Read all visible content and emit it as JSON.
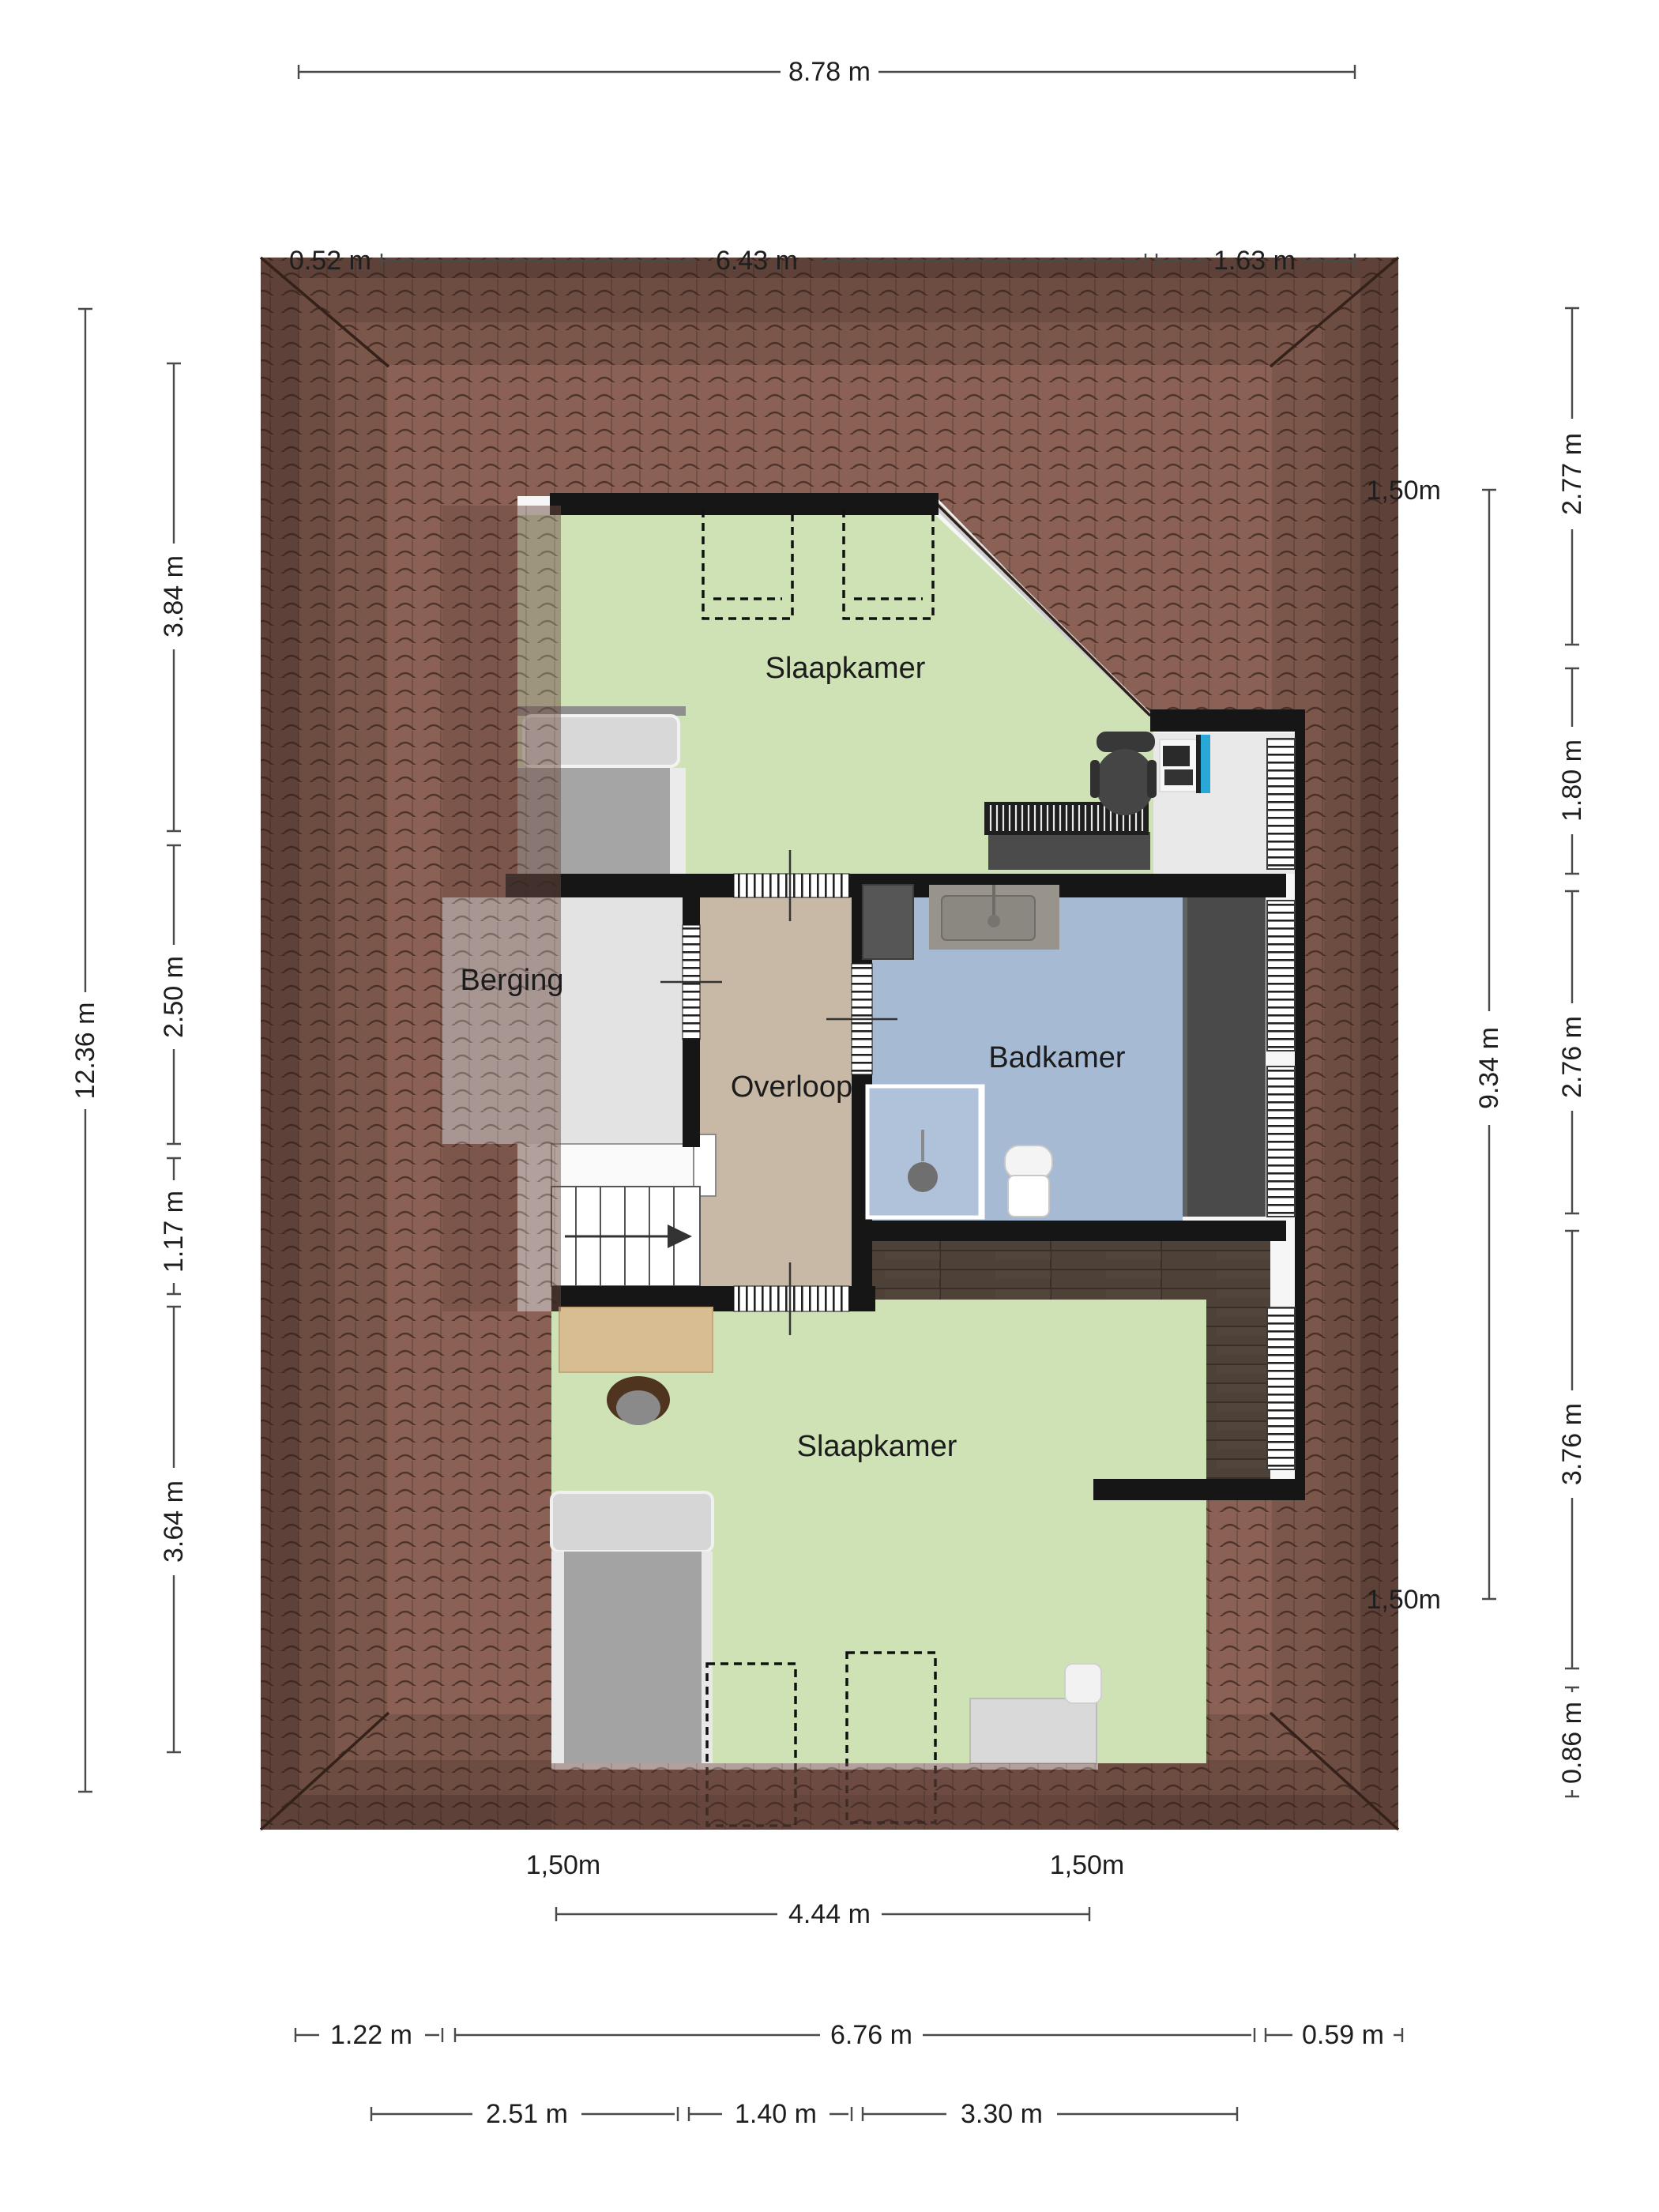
{
  "title": "floor-plan-attic",
  "rooms": {
    "bedroom_top": "Slaapkamer",
    "storage": "Berging",
    "landing": "Overloop",
    "bathroom": "Badkamer",
    "bedroom_bottom": "Slaapkamer"
  },
  "dimensions": {
    "top": {
      "total": "8.78 m",
      "left": "0.52 m",
      "middle": "6.43 m",
      "right": "1.63 m"
    },
    "left": {
      "total": "12.36 m",
      "segments": [
        "3.84 m",
        "2.50 m",
        "1.17 m",
        "3.64 m"
      ]
    },
    "right": {
      "segments": [
        "2.77 m",
        "1.80 m",
        "2.76 m",
        "3.76 m",
        "0.86 m"
      ],
      "inner_total": "9.34 m",
      "height_line_top": "1,50m",
      "height_line_bottom": "1,50m"
    },
    "bottom": {
      "height_line_left": "1,50m",
      "height_line_right": "1,50m",
      "inner_width": "4.44 m",
      "row2": [
        "1.22 m",
        "6.76 m",
        "0.59 m"
      ],
      "row3": [
        "2.51 m",
        "1.40 m",
        "3.30 m"
      ]
    }
  },
  "colors": {
    "roof_dark": "#5e4138",
    "roof_mid1": "#6d4c42",
    "roof_mid2": "#7b564a",
    "roof_light": "#8a6154",
    "floor_green": "#cfe2b6",
    "floor_tan": "#c8b8a6",
    "floor_grey": "#e3e3e3",
    "floor_blue": "#a6bad4",
    "wall": "#161616",
    "wood": "#4d4138",
    "monitor_blue": "#29a8d8"
  }
}
